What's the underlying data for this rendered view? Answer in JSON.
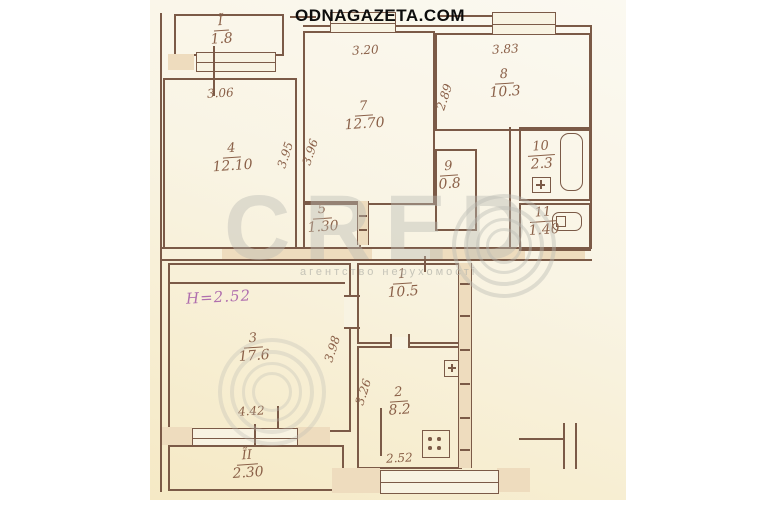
{
  "banner": {
    "site_label": "ODNAGAZETA.COM"
  },
  "plan": {
    "ceiling_height_note": "H=2.52",
    "rooms": [
      {
        "num": "Ĩ",
        "area": "1.8"
      },
      {
        "num": "4",
        "area": "12.10"
      },
      {
        "num": "7",
        "area": "12.70"
      },
      {
        "num": "8",
        "area": "10.3"
      },
      {
        "num": "5",
        "area": "1.30"
      },
      {
        "num": "9",
        "area": "0.8"
      },
      {
        "num": "10",
        "area": "2.3"
      },
      {
        "num": "11",
        "area": "1.40"
      },
      {
        "num": "1",
        "area": "10.5"
      },
      {
        "num": "3",
        "area": "17.6"
      },
      {
        "num": "2",
        "area": "8.2"
      },
      {
        "num": "ĨI",
        "area": "2.30"
      }
    ],
    "dimensions": [
      {
        "value": "3.06"
      },
      {
        "value": "3.20"
      },
      {
        "value": "3.83"
      },
      {
        "value": "3.95"
      },
      {
        "value": "3.96"
      },
      {
        "value": "2.89"
      },
      {
        "value": "3.98"
      },
      {
        "value": "4.42"
      },
      {
        "value": "3.26"
      },
      {
        "value": "2.52"
      }
    ]
  },
  "watermark": {
    "brand": "CRED",
    "caption": "агентство нерухомості"
  },
  "colors": {
    "ink": "#7b5a47",
    "paper": "#f8f3e2",
    "wall_fill": "#eedcbe",
    "height_note": "#b06fae",
    "watermark_gray": "#b9b9b2"
  }
}
